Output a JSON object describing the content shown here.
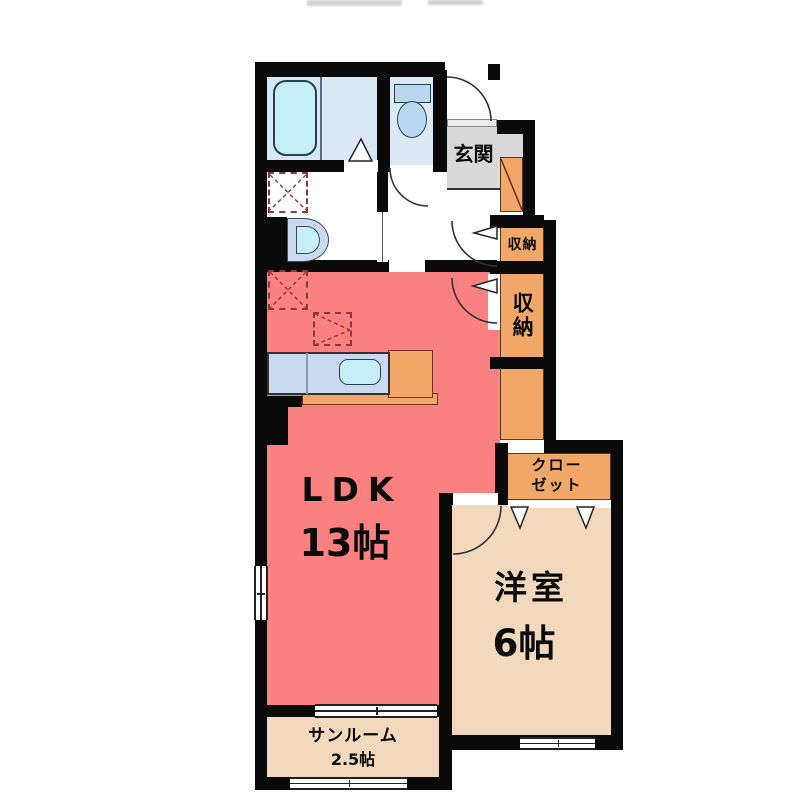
{
  "title": "apartment-floor-plan",
  "rooms": {
    "ldk": {
      "name": "LDK",
      "size": "13帖"
    },
    "western": {
      "name": "洋室",
      "size": "6帖"
    },
    "sunroom": {
      "name": "サンルーム",
      "size": "2.5帖"
    },
    "entrance": {
      "name": "玄関"
    },
    "storage_small": {
      "name": "収納"
    },
    "storage_large": {
      "name": "収納"
    },
    "closet": {
      "name_line1": "クロー",
      "name_line2": "ゼット"
    }
  },
  "colors": {
    "wall": "#0a0a0a",
    "pink": "#fb8181",
    "orange": "#f0a767",
    "beige": "#f2d9be",
    "gray": "#d8d8d8",
    "bath_blue": "#d9e6f4",
    "toilet_blue": "#dee9f6",
    "fixture_blue": "#bcd8f0",
    "cyan": "#c5eff7",
    "counter_blue": "#c9d9ef",
    "line_red": "#8a3a3a"
  }
}
